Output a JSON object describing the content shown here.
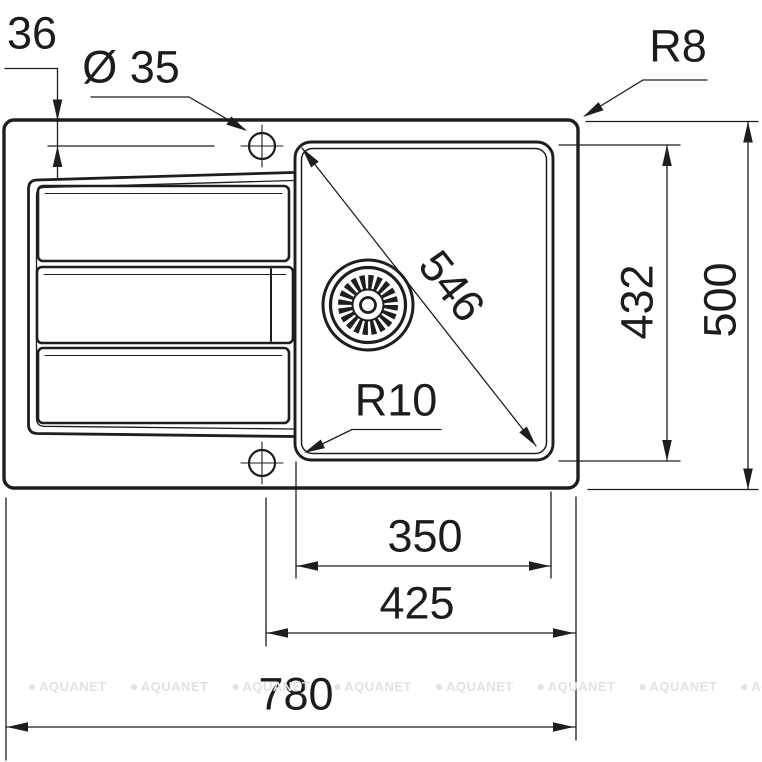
{
  "drawing": {
    "title": "sink-top-view-dimension-drawing",
    "colors": {
      "ink": "#1e1e1e",
      "watermark": "#e2e2e4"
    },
    "dims": {
      "tap_offset": "36",
      "tap_hole_diameter": "Ø 35",
      "outer_corner_radius": "R8",
      "bowl_diagonal": "546",
      "bowl_length": "432",
      "overall_depth": "500",
      "bowl_corner_radius": "R10",
      "bowl_width": "350",
      "drain_to_edge": "425",
      "overall_width": "780"
    }
  },
  "watermark": {
    "icon": "●",
    "text": "AQUANET"
  }
}
